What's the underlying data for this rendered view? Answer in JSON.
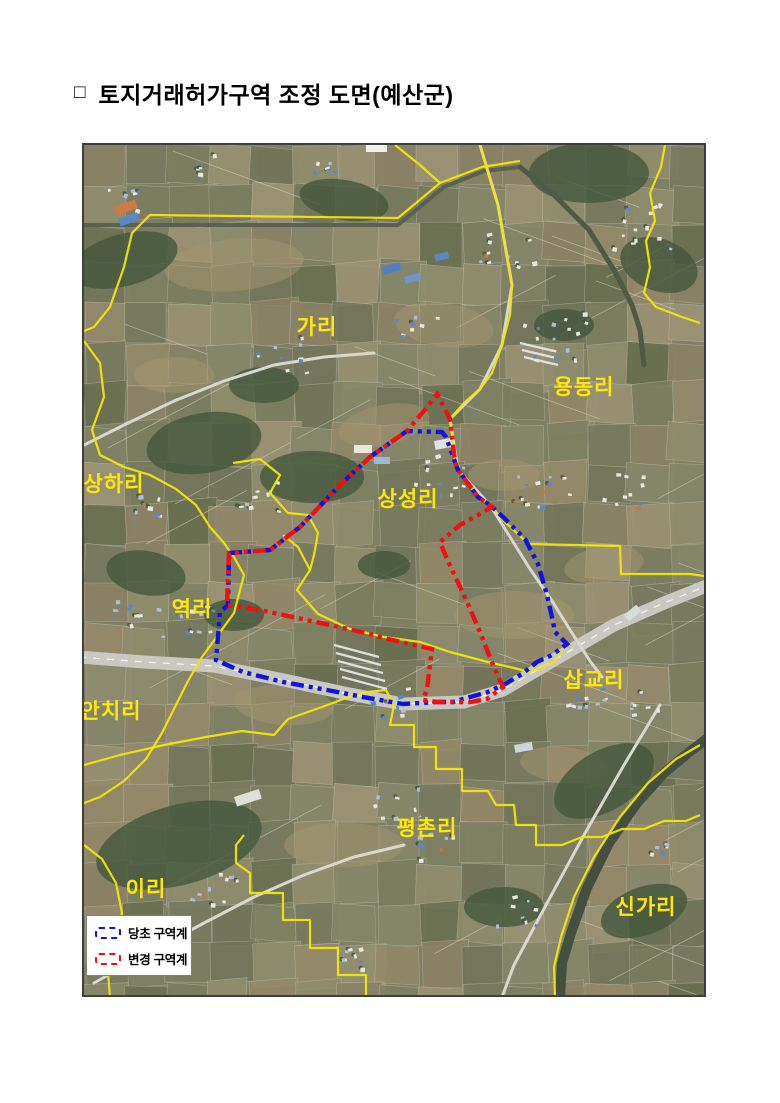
{
  "page": {
    "background": "#ffffff"
  },
  "title": {
    "bullet": "□",
    "text": "토지거래허가구역 조정 도면(예산군)"
  },
  "map": {
    "frame": {
      "left": 82,
      "top": 143,
      "width": 620,
      "height": 850
    },
    "colors": {
      "base": "#7e7f63",
      "admin_boundary": "#f2e60a",
      "original_zone": "#1212dd",
      "changed_zone": "#ee1111",
      "label_text": "#ffe809"
    },
    "labels": [
      {
        "text": "가리",
        "x": 233,
        "y": 189
      },
      {
        "text": "용동리",
        "x": 500,
        "y": 249
      },
      {
        "text": "상하리",
        "x": 30,
        "y": 346
      },
      {
        "text": "상성리",
        "x": 324,
        "y": 361
      },
      {
        "text": "역리",
        "x": 108,
        "y": 471
      },
      {
        "text": "삽교리",
        "x": 510,
        "y": 542
      },
      {
        "text": "안치리",
        "x": 27,
        "y": 573
      },
      {
        "text": "평촌리",
        "x": 343,
        "y": 690
      },
      {
        "text": "이리",
        "x": 62,
        "y": 751
      },
      {
        "text": "신가리",
        "x": 562,
        "y": 769
      }
    ],
    "zones": {
      "original": {
        "name": "당초 구역계",
        "points": [
          [
            145,
            408
          ],
          [
            186,
            405
          ],
          [
            216,
            382
          ],
          [
            256,
            340
          ],
          [
            286,
            312
          ],
          [
            323,
            286
          ],
          [
            358,
            287
          ],
          [
            362,
            292
          ],
          [
            371,
            317
          ],
          [
            374,
            325
          ],
          [
            394,
            352
          ],
          [
            406,
            360
          ],
          [
            419,
            372
          ],
          [
            429,
            382
          ],
          [
            441,
            394
          ],
          [
            454,
            419
          ],
          [
            463,
            450
          ],
          [
            469,
            477
          ],
          [
            471,
            487
          ],
          [
            483,
            499
          ],
          [
            468,
            510
          ],
          [
            453,
            517
          ],
          [
            438,
            529
          ],
          [
            421,
            539
          ],
          [
            404,
            547
          ],
          [
            386,
            552
          ],
          [
            369,
            557
          ],
          [
            353,
            557
          ],
          [
            319,
            559
          ],
          [
            279,
            552
          ],
          [
            243,
            545
          ],
          [
            199,
            537
          ],
          [
            159,
            527
          ],
          [
            132,
            515
          ],
          [
            136,
            467
          ],
          [
            144,
            460
          ]
        ]
      },
      "changed": {
        "name": "변경 구역계",
        "points": [
          [
            353,
            249
          ],
          [
            366,
            274
          ],
          [
            371,
            317
          ],
          [
            374,
            325
          ],
          [
            394,
            352
          ],
          [
            408,
            362
          ],
          [
            376,
            380
          ],
          [
            356,
            397
          ],
          [
            363,
            414
          ],
          [
            383,
            457
          ],
          [
            396,
            487
          ],
          [
            409,
            520
          ],
          [
            419,
            542
          ],
          [
            403,
            554
          ],
          [
            386,
            557
          ],
          [
            353,
            557
          ],
          [
            339,
            555
          ],
          [
            343,
            544
          ],
          [
            348,
            504
          ],
          [
            304,
            494
          ],
          [
            286,
            489
          ],
          [
            246,
            480
          ],
          [
            176,
            465
          ],
          [
            143,
            460
          ],
          [
            145,
            408
          ],
          [
            186,
            405
          ],
          [
            216,
            382
          ],
          [
            256,
            340
          ],
          [
            286,
            312
          ],
          [
            323,
            286
          ],
          [
            339,
            267
          ]
        ]
      }
    },
    "admin_lines": [
      [
        [
          0,
          186
        ],
        [
          10,
          182
        ],
        [
          26,
          162
        ],
        [
          40,
          122
        ],
        [
          48,
          88
        ],
        [
          66,
          70
        ],
        [
          314,
          73
        ],
        [
          356,
          38
        ],
        [
          398,
          22
        ],
        [
          436,
          16
        ]
      ],
      [
        [
          311,
          0
        ],
        [
          336,
          20
        ],
        [
          356,
          38
        ]
      ],
      [
        [
          581,
          0
        ],
        [
          577,
          22
        ],
        [
          566,
          48
        ],
        [
          571,
          76
        ],
        [
          562,
          96
        ],
        [
          566,
          122
        ],
        [
          560,
          148
        ],
        [
          572,
          162
        ],
        [
          598,
          172
        ],
        [
          616,
          178
        ]
      ],
      [
        [
          396,
          0
        ],
        [
          404,
          28
        ],
        [
          414,
          60
        ],
        [
          421,
          100
        ],
        [
          428,
          140
        ],
        [
          426,
          170
        ],
        [
          418,
          200
        ],
        [
          408,
          228
        ],
        [
          396,
          244
        ],
        [
          380,
          258
        ],
        [
          366,
          274
        ],
        [
          371,
          317
        ],
        [
          374,
          325
        ],
        [
          394,
          352
        ],
        [
          406,
          360
        ]
      ],
      [
        [
          406,
          360
        ],
        [
          420,
          376
        ],
        [
          437,
          392
        ],
        [
          445,
          399
        ],
        [
          536,
          401
        ],
        [
          537,
          429
        ],
        [
          606,
          429
        ],
        [
          620,
          431
        ]
      ],
      [
        [
          0,
          196
        ],
        [
          16,
          218
        ],
        [
          20,
          252
        ],
        [
          8,
          285
        ],
        [
          16,
          310
        ],
        [
          40,
          322
        ],
        [
          66,
          330
        ],
        [
          92,
          344
        ],
        [
          112,
          360
        ],
        [
          126,
          382
        ],
        [
          140,
          398
        ],
        [
          150,
          412
        ],
        [
          160,
          430
        ],
        [
          150,
          468
        ],
        [
          134,
          490
        ],
        [
          118,
          512
        ],
        [
          104,
          536
        ],
        [
          92,
          560
        ],
        [
          78,
          588
        ],
        [
          62,
          614
        ],
        [
          40,
          636
        ],
        [
          16,
          652
        ],
        [
          0,
          658
        ]
      ],
      [
        [
          149,
          318
        ],
        [
          176,
          314
        ],
        [
          196,
          330
        ],
        [
          186,
          348
        ],
        [
          204,
          368
        ],
        [
          224,
          370
        ],
        [
          234,
          388
        ],
        [
          230,
          410
        ],
        [
          226,
          425
        ]
      ],
      [
        [
          199,
          390
        ],
        [
          214,
          402
        ],
        [
          226,
          425
        ],
        [
          213,
          445
        ],
        [
          234,
          469
        ],
        [
          266,
          484
        ],
        [
          300,
          492
        ],
        [
          336,
          497
        ],
        [
          366,
          507
        ],
        [
          400,
          516
        ],
        [
          430,
          523
        ],
        [
          446,
          527
        ],
        [
          470,
          517
        ],
        [
          483,
          499
        ]
      ],
      [
        [
          0,
          620
        ],
        [
          36,
          610
        ],
        [
          80,
          600
        ],
        [
          122,
          592
        ],
        [
          158,
          586
        ],
        [
          190,
          590
        ],
        [
          204,
          574
        ],
        [
          238,
          562
        ],
        [
          262,
          553
        ],
        [
          284,
          547
        ],
        [
          302,
          545
        ],
        [
          310,
          560
        ],
        [
          306,
          580
        ],
        [
          330,
          580
        ],
        [
          330,
          602
        ],
        [
          352,
          602
        ],
        [
          352,
          624
        ],
        [
          378,
          624
        ],
        [
          378,
          646
        ],
        [
          404,
          646
        ],
        [
          412,
          660
        ],
        [
          430,
          660
        ],
        [
          432,
          680
        ],
        [
          452,
          680
        ],
        [
          452,
          700
        ],
        [
          478,
          700
        ],
        [
          498,
          692
        ],
        [
          518,
          692
        ],
        [
          538,
          684
        ],
        [
          560,
          684
        ],
        [
          580,
          676
        ],
        [
          602,
          676
        ],
        [
          616,
          670
        ]
      ],
      [
        [
          160,
          690
        ],
        [
          152,
          700
        ],
        [
          152,
          718
        ],
        [
          166,
          728
        ],
        [
          166,
          748
        ],
        [
          199,
          748
        ],
        [
          199,
          775
        ],
        [
          226,
          775
        ],
        [
          226,
          803
        ],
        [
          254,
          803
        ],
        [
          254,
          830
        ],
        [
          282,
          830
        ],
        [
          282,
          852
        ]
      ],
      [
        [
          616,
          600
        ],
        [
          592,
          614
        ],
        [
          564,
          638
        ],
        [
          536,
          672
        ],
        [
          510,
          712
        ],
        [
          490,
          752
        ],
        [
          477,
          792
        ],
        [
          470,
          822
        ],
        [
          471,
          852
        ]
      ],
      [
        [
          0,
          700
        ],
        [
          18,
          714
        ],
        [
          32,
          738
        ],
        [
          38,
          768
        ],
        [
          30,
          800
        ],
        [
          24,
          828
        ],
        [
          26,
          852
        ]
      ]
    ],
    "legend": {
      "items": [
        {
          "label": "당초 구역계"
        },
        {
          "label": "변경 구역계"
        }
      ]
    }
  }
}
